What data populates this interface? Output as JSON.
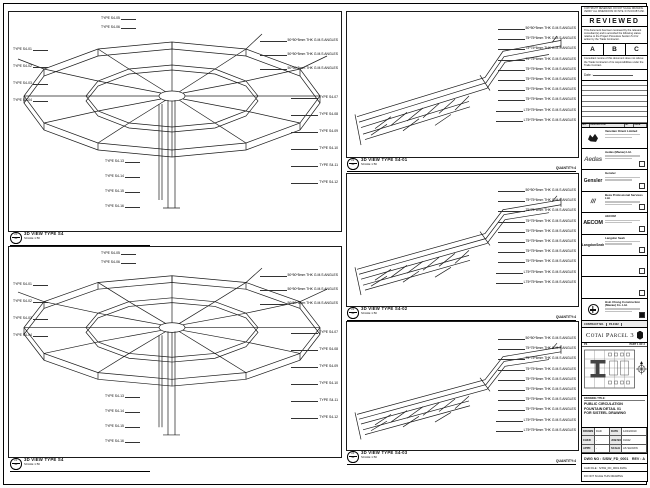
{
  "panels": {
    "left": [
      {
        "bubble": {
          "top": "20",
          "bottom": "S4"
        },
        "title": "3D VIEW TYPE S4",
        "scale": "SCALE 1:50",
        "left_labels": [
          "TYPE S4-01",
          "TYPE S4-02",
          "TYPE S4-03",
          "TYPE S4-04"
        ],
        "top_labels": [
          "TYPE S4-05",
          "TYPE S4-06"
        ],
        "spec_labels": [
          "50*50*5mm THK G.M.S ANGLES",
          "50*50*5mm THK G.M.S ANGLES",
          "50*50*5mm THK G.M.S ANGLES"
        ],
        "right_labels": [
          "TYPE S4-07",
          "TYPE S4-08",
          "TYPE S4-09",
          "TYPE S4-10",
          "TYPE S4-11",
          "TYPE S4-12"
        ],
        "bottom_labels": [
          "TYPE S4-13",
          "TYPE S4-14",
          "TYPE S4-15",
          "TYPE S4-16"
        ]
      },
      {
        "bubble": {
          "top": "21",
          "bottom": "S4"
        },
        "title": "3D VIEW TYPE S4",
        "scale": "SCALE 1:50",
        "left_labels": [
          "TYPE S4-01",
          "TYPE S4-02",
          "TYPE S4-03",
          "TYPE S4-04"
        ],
        "top_labels": [
          "TYPE S4-05",
          "TYPE S4-06"
        ],
        "spec_labels": [
          "50*50*5mm THK G.M.S ANGLES",
          "50*50*5mm THK G.M.S ANGLES",
          "50*50*5mm THK G.M.S ANGLES"
        ],
        "right_labels": [
          "TYPE S4-07",
          "TYPE S4-08",
          "TYPE S4-09",
          "TYPE S4-10",
          "TYPE S4-11",
          "TYPE S4-12"
        ],
        "bottom_labels": [
          "TYPE S4-13",
          "TYPE S4-14",
          "TYPE S4-15",
          "TYPE S4-16"
        ]
      }
    ],
    "middle": [
      {
        "bubble": {
          "top": "22",
          "bottom": "S4"
        },
        "title": "3D VIEW TYPE S4-01",
        "scale": "SCALE 1:50",
        "quantity": "QUANTITY:4",
        "labels": [
          "50*50*5mm THK G.M.S ANGLES",
          "75*75*6mm THK G.M.S ANGLES",
          "75*75*6mm THK G.M.S ANGLES",
          "75*75*6mm THK G.M.S ANGLES",
          "75*75*6mm THK G.M.S ANGLES",
          "75*75*6mm THK G.M.S ANGLES",
          "75*75*6mm THK G.M.S ANGLES",
          "75*75*6mm THK G.M.S ANGLES",
          "L75*75*6mm THK G.M.S ANGLES",
          "L75*75*6mm THK G.M.S ANGLES"
        ]
      },
      {
        "bubble": {
          "top": "23",
          "bottom": "S4"
        },
        "title": "3D VIEW TYPE S4-02",
        "scale": "SCALE 1:50",
        "quantity": "QUANTITY:4",
        "labels": [
          "50*50*5mm THK G.M.S ANGLES",
          "75*75*6mm THK G.M.S ANGLES",
          "75*75*6mm THK G.M.S ANGLES",
          "75*75*6mm THK G.M.S ANGLES",
          "75*75*6mm THK G.M.S ANGLES",
          "75*75*6mm THK G.M.S ANGLES",
          "75*75*6mm THK G.M.S ANGLES",
          "75*75*6mm THK G.M.S ANGLES",
          "L75*75*6mm THK G.M.S ANGLES",
          "L75*75*6mm THK G.M.S ANGLES"
        ]
      },
      {
        "bubble": {
          "top": "24",
          "bottom": "S4"
        },
        "title": "3D VIEW TYPE S4-03",
        "scale": "SCALE 1:50",
        "quantity": "QUANTITY:4",
        "labels": [
          "50*50*5mm THK G.M.S ANGLES",
          "75*75*6mm THK G.M.S ANGLES",
          "75*75*6mm THK G.M.S ANGLES",
          "75*75*6mm THK G.M.S ANGLES",
          "75*75*6mm THK G.M.S ANGLES",
          "75*75*6mm THK G.M.S ANGLES",
          "75*75*6mm THK G.M.S ANGLES",
          "75*75*6mm THK G.M.S ANGLES",
          "L75*75*6mm THK G.M.S ANGLES",
          "L75*75*6mm THK G.M.S ANGLES"
        ]
      }
    ]
  },
  "titleblock": {
    "top_note": "COPYRIGHT RESERVED. DO NOT SCALE DRAWING. VERIFY ALL DIMENSIONS ON SITE. IF IN DOUBT ASK.",
    "reviewed": {
      "title": "REVIEWED",
      "para1": "This document has been reviewed by the relevant consultant(s) and is accorded the following status relative to the Project Procedure Section 5.4 for action by the Trade Contractor.",
      "statuses": [
        "A",
        "B",
        "C"
      ],
      "para2": "Consultant review of this document does not relieve the Trade Contractor of its responsibilities under the Trade Contract.",
      "date_label": "Date :"
    },
    "revisions": {
      "headers": [
        "NO.",
        "DESCRIPTION",
        "BY",
        "DATE"
      ],
      "empty_rows": 8
    },
    "companies": [
      {
        "logo_text": "",
        "logo": "venetian-mark",
        "name": "Venetian Orient Limited",
        "checkbox": "none"
      },
      {
        "logo_text": "Aedas",
        "logo": "",
        "name": "Aedas (Macau) Ltd.",
        "checkbox": "empty"
      },
      {
        "logo_text": "Gensler",
        "logo": "",
        "name": "Gensler",
        "checkbox": "empty"
      },
      {
        "logo_text": "///",
        "logo": "",
        "name": "Beca Professional Services Ltd.",
        "checkbox": "empty"
      },
      {
        "logo_text": "AECOM",
        "logo": "",
        "name": "AECOM",
        "checkbox": "empty"
      },
      {
        "logo_text": "LangdonSeah",
        "logo": "",
        "name": "Langdon Seah",
        "checkbox": "empty"
      },
      {
        "logo_text": "",
        "logo": "",
        "name": "",
        "checkbox": "empty"
      },
      {
        "logo_text": "",
        "logo": "",
        "name": "",
        "checkbox": "empty"
      },
      {
        "logo_text": "",
        "logo": "hsinchong-mark",
        "name": "Hsin Chong Construction (Macau) Co. Ltd.",
        "checkbox": "filled"
      }
    ],
    "contract_strip": {
      "label": "CONTRACT NO.",
      "value": "P3-0102"
    },
    "project_name": "Cotai Parcel 3",
    "key_plan": {
      "left": "P3",
      "right": "PART 1 OF 2"
    },
    "drawing_title": {
      "label": "DRAWING TITLE:",
      "lines": [
        "PUBLIC CIRCULATION",
        "FOUNTAIN DETAIL 01",
        "FOR S/STEEL DRAWING"
      ]
    },
    "info": {
      "rows": [
        [
          "DRAWN",
          "DAD",
          "DATE",
          "12/04/2010"
        ],
        [
          "CHKD",
          "-",
          "JOB NO",
          "01042"
        ],
        [
          "APPD",
          "-",
          "SCALE",
          "AS SHOWN"
        ]
      ],
      "dwg_label": "DWG NO :",
      "dwg_no": "S/SW_FD_0001",
      "rev_label": "REV :",
      "rev": "A",
      "cad_label": "CAD FILE :",
      "cad": "S/SW_FD_0001.DWG",
      "note": "DO NOT SCALE THIS DRAWING"
    }
  }
}
